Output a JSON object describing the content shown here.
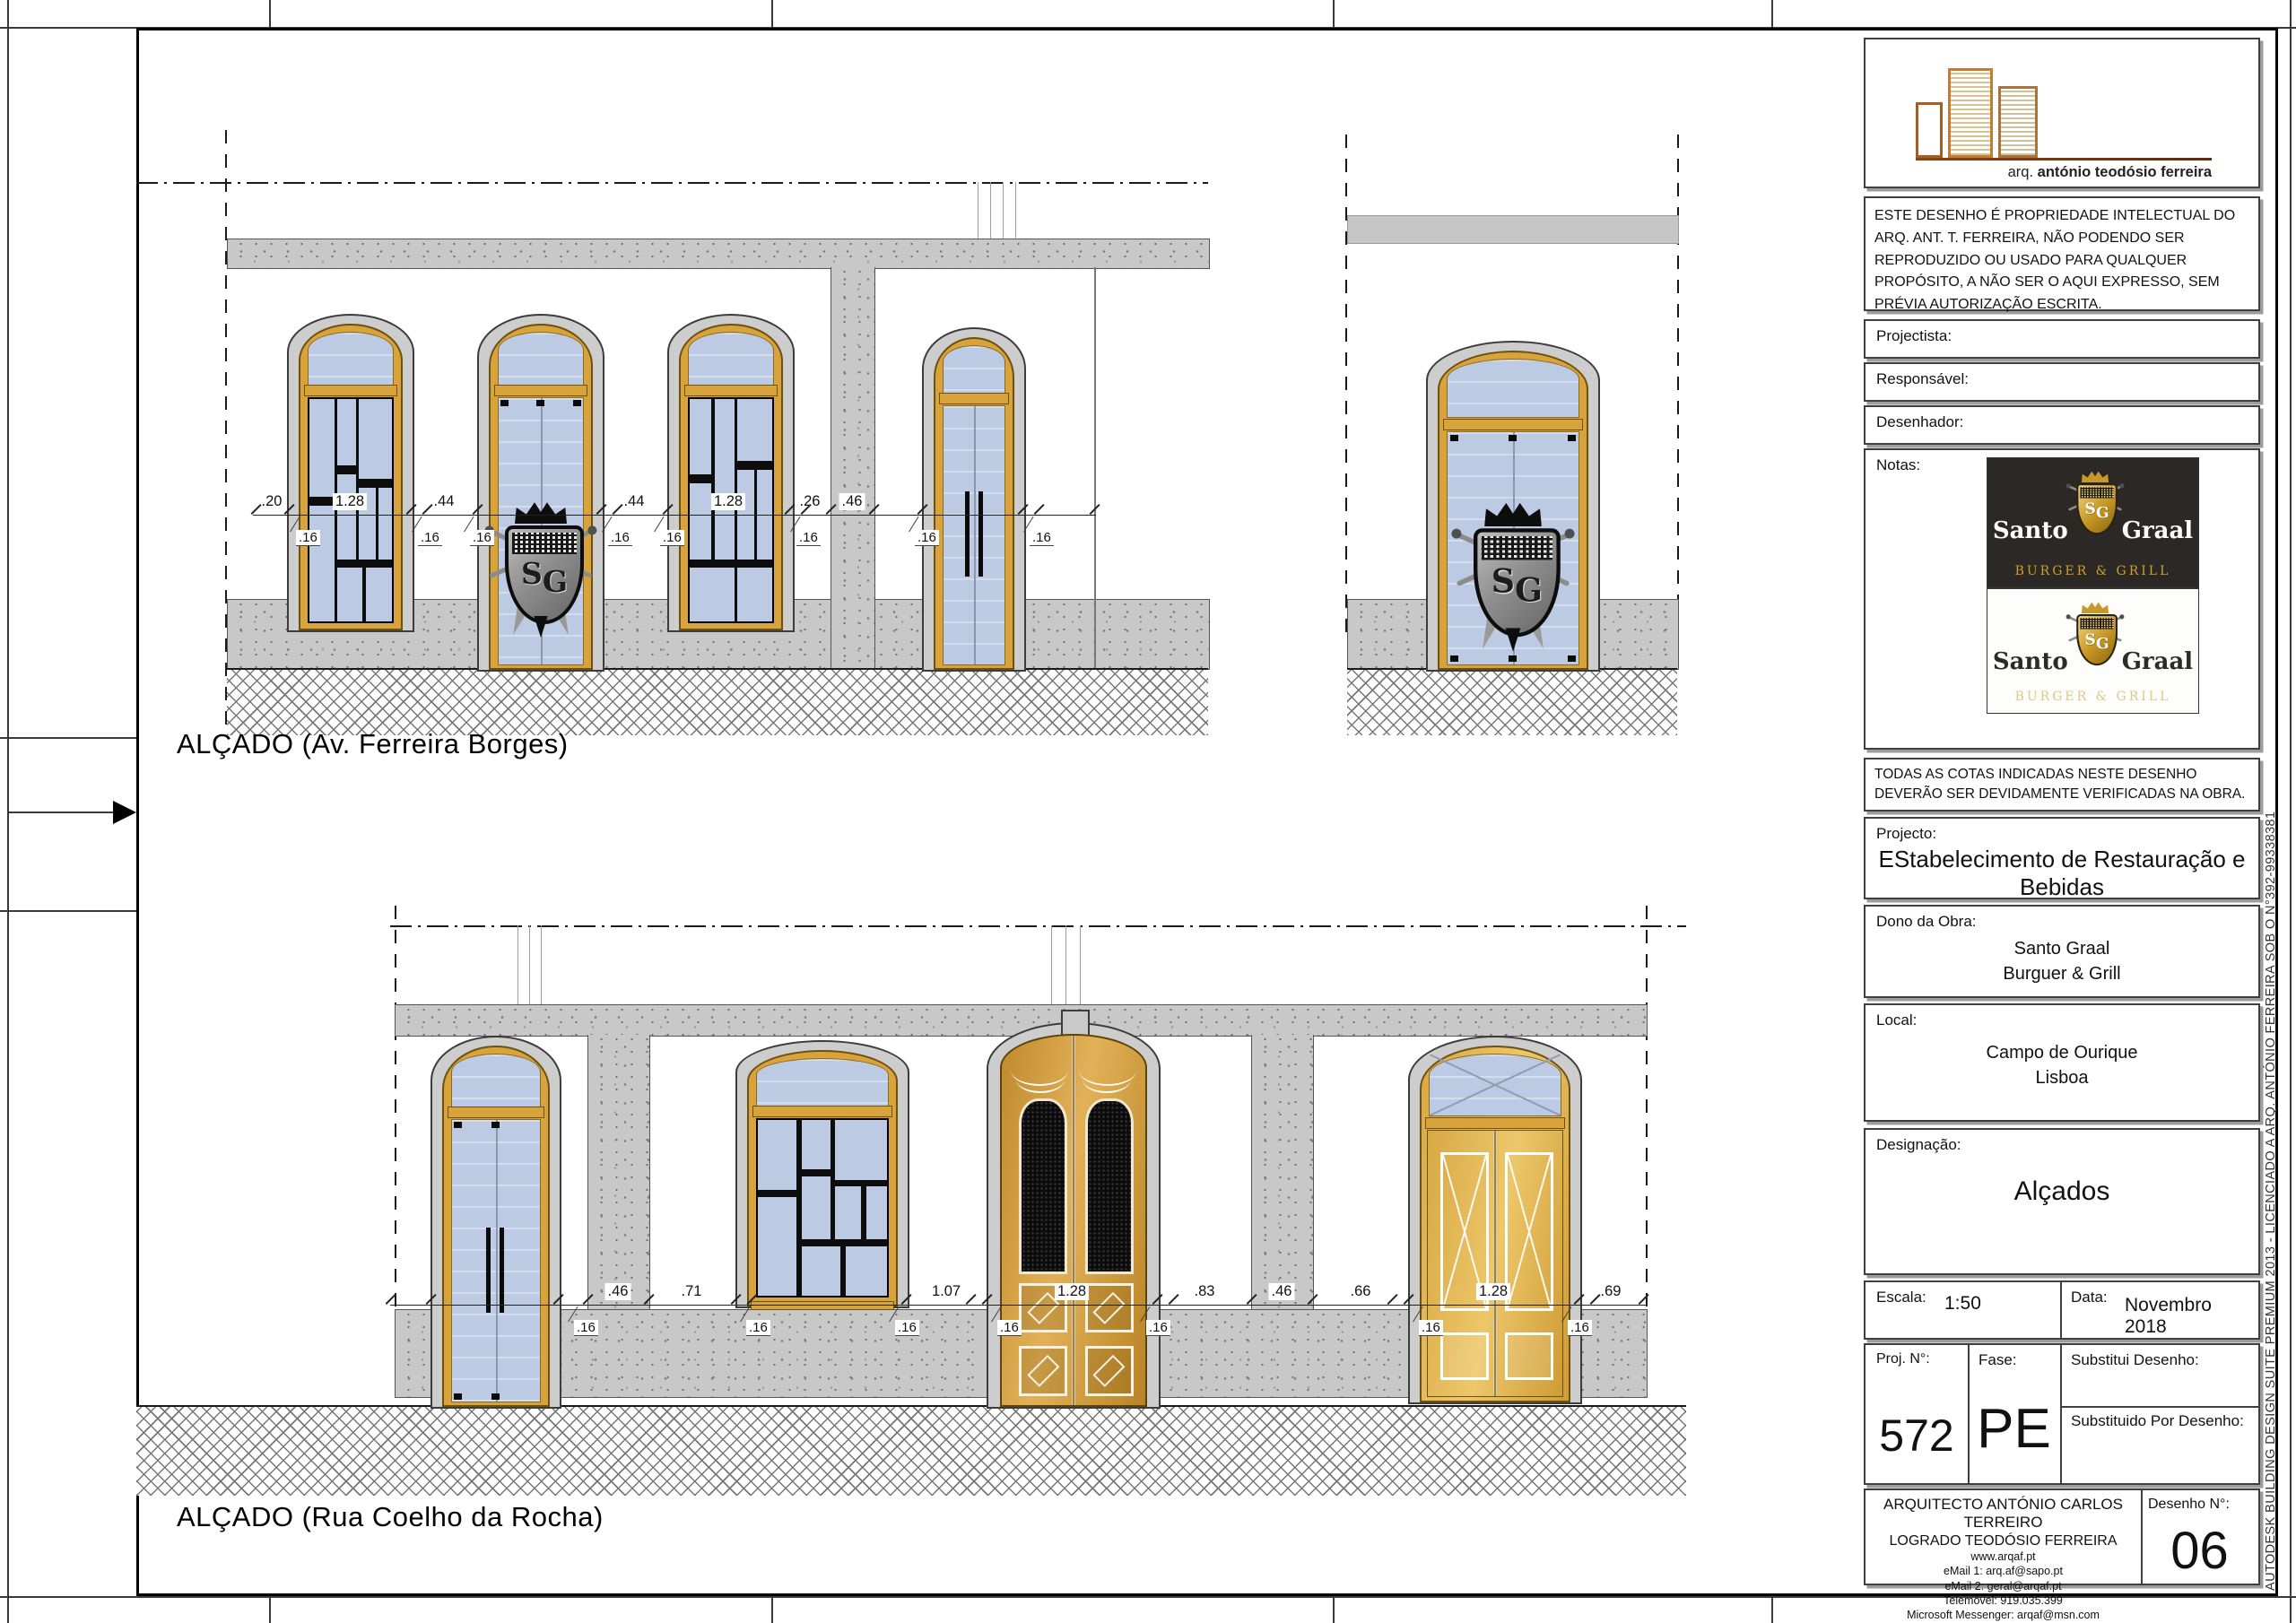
{
  "drawing": {
    "emblem_initials_s": "S",
    "emblem_initials_g": "G",
    "top_elevation": {
      "title": "ALÇADO (Av. Ferreira Borges)",
      "dims_main": [
        ".20",
        "1.28",
        ".44",
        ".44",
        "1.28",
        ".26",
        ".46"
      ],
      "dims_sub": [
        ".16",
        ".16",
        ".16",
        ".16",
        ".16",
        ".16",
        ".16",
        ".16"
      ]
    },
    "bottom_elevation": {
      "title": "ALÇADO (Rua Coelho da Rocha)",
      "dims_main": [
        ".46",
        ".71",
        "1.07",
        "1.28",
        ".83",
        ".46",
        ".66",
        "1.28",
        ".69"
      ],
      "dims_sub": [
        ".16",
        ".16",
        ".16",
        ".16",
        ".16",
        ".16",
        ".16"
      ]
    }
  },
  "title_block": {
    "logo_caption_prefix": "arq.",
    "logo_caption_name": "antónio teodósio ferreira",
    "copyright": "ESTE DESENHO É PROPRIEDADE INTELECTUAL DO ARQ. ANT. T. FERREIRA, NÃO PODENDO SER REPRODUZIDO OU USADO PARA QUALQUER PROPÓSITO, A NÃO SER O AQUI EXPRESSO, SEM PRÉVIA AUTORIZAÇÃO ESCRITA.",
    "projectista_label": "Projectista:",
    "responsavel_label": "Responsável:",
    "desenhador_label": "Desenhador:",
    "notas_label": "Notas:",
    "brand": {
      "name_left": "Santo",
      "name_right": "Graal",
      "tagline": "BURGER & GRILL"
    },
    "verification_note": "TODAS AS COTAS INDICADAS NESTE DESENHO DEVERÃO SER DEVIDAMENTE VERIFICADAS NA OBRA.",
    "projecto": {
      "label": "Projecto:",
      "value": "EStabelecimento de Restauração e Bebidas"
    },
    "dono": {
      "label": "Dono da Obra:",
      "line1": "Santo Graal",
      "line2": "Burguer & Grill"
    },
    "local": {
      "label": "Local:",
      "line1": "Campo de Ourique",
      "line2": "Lisboa"
    },
    "designacao": {
      "label": "Designação:",
      "value": "Alçados"
    },
    "escala": {
      "label": "Escala:",
      "value": "1:50"
    },
    "data": {
      "label": "Data:",
      "value": "Novembro 2018"
    },
    "proj_n": {
      "label": "Proj. N°:",
      "value": "572"
    },
    "fase": {
      "label": "Fase:",
      "value": "PE"
    },
    "substitui_label": "Substitui Desenho:",
    "substituido_label": "Substituido Por Desenho:",
    "architect": {
      "line1": "ARQUITECTO ANTÓNIO CARLOS TERREIRO",
      "line2": "LOGRADO TEODÓSIO FERREIRA",
      "contacts": [
        "www.arqaf.pt",
        "eMail 1: arq.af@sapo.pt",
        "eMail 2: geral@arqaf.pt",
        "Telemóvel: 919.035.399",
        "Microsoft Messenger: arqaf@msn.com",
        "Skype: antonioferreira1610"
      ]
    },
    "desenho_n": {
      "label": "Desenho N°:",
      "value": "06"
    },
    "plot_stamp": "AUTODESK BUILDING DESIGN SUITE PREMIUM 2013 - LICENCIADO A ARQ. ANTÓNIO FERREIRA SOB O N°392-99338381"
  },
  "colors": {
    "gold_frame": "#d9a33c",
    "glass_blue": "#bccbe3",
    "stone_gray": "#c8c8c8",
    "logo_copper": "#c27c33",
    "brand_gold": "#c9a227"
  }
}
